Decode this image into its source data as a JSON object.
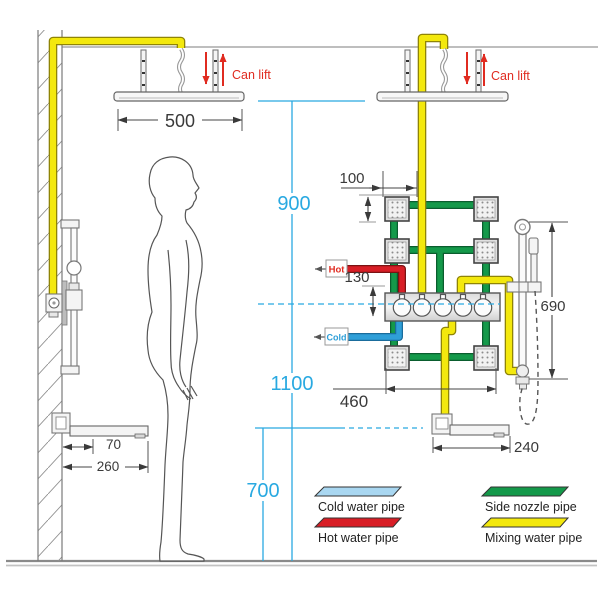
{
  "labels": {
    "can_lift": "Can lift",
    "hot": "Hot",
    "cold": "Cold"
  },
  "dimensions": {
    "head_width": "500",
    "nozzle_size": "100",
    "hot_inlet_offset": "130",
    "head_to_valve_height": "900",
    "valve_center_height": "1100",
    "spout_height": "700",
    "nozzle_panel_width": "460",
    "slide_bar_length": "690",
    "right_spout_reach": "240",
    "left_spout_depth": "70",
    "left_spout_reach": "260"
  },
  "legend": {
    "items": [
      {
        "label": "Cold water pipe",
        "color": "#a9d7f1"
      },
      {
        "label": "Hot water pipe",
        "color": "#d81e26"
      },
      {
        "label": "Side nozzle pipe",
        "color": "#14994a"
      },
      {
        "label": "Mixing water pipe",
        "color": "#f3e80d"
      }
    ]
  },
  "colors": {
    "cold_pipe": "#2f9fd8",
    "hot_pipe": "#d81e26",
    "nozzle_pipe": "#14994a",
    "mixing_pipe": "#f3e80d",
    "dimension_cyan": "#29a9e1",
    "annotation_red": "#e02b20"
  }
}
